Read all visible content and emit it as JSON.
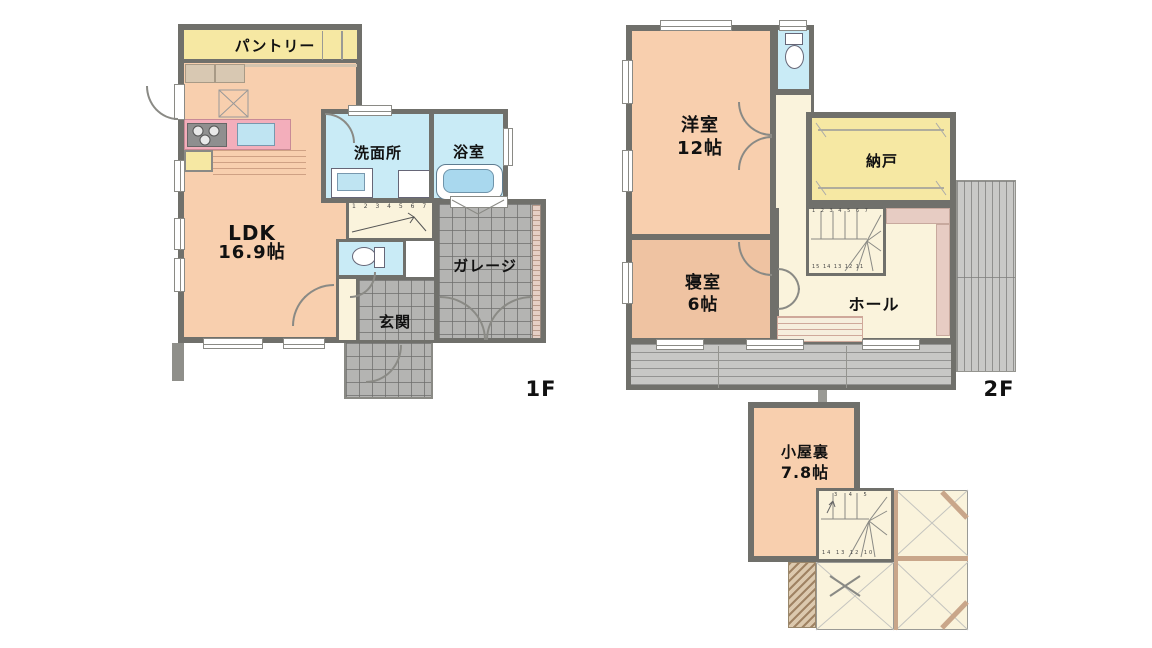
{
  "palette": {
    "wall": "#70706b",
    "room_peach": "#F8CFAE",
    "room_tan": "#EFC3A2",
    "room_yellow": "#F6E8A3",
    "room_blue": "#C9EBF6",
    "room_cream": "#FAF3DC",
    "tile_gray": "#B4B4B2",
    "balcony_gray": "#C7C7C5",
    "counter_pink": "#F3AEBB",
    "walkway_pink": "#E7CCC3",
    "beam_tan": "#C9A68A"
  },
  "floor1": {
    "floor_label": "1F",
    "pantry_label": "パントリー",
    "ldk_name": "LDK",
    "ldk_size": "16.9帖",
    "washroom_label": "洗面所",
    "bath_label": "浴室",
    "entrance_label": "玄関",
    "garage_label": "ガレージ",
    "stair_numbers": "1 2 3 4 5 6 7"
  },
  "floor2": {
    "floor_label": "2F",
    "western_name": "洋室",
    "western_size": "12帖",
    "storage_label": "納戸",
    "bedroom_name": "寝室",
    "bedroom_size": "6帖",
    "hall_label": "ホール",
    "stair_numbers_top": "1 2 3 4 5 6 7",
    "stair_numbers_bottom": "15 14 13 12 11"
  },
  "attic": {
    "room_name": "小屋裏",
    "room_size": "7.8帖",
    "stair_numbers_top": "3 4 5",
    "stair_numbers_bottom": "14 13 12 10"
  }
}
